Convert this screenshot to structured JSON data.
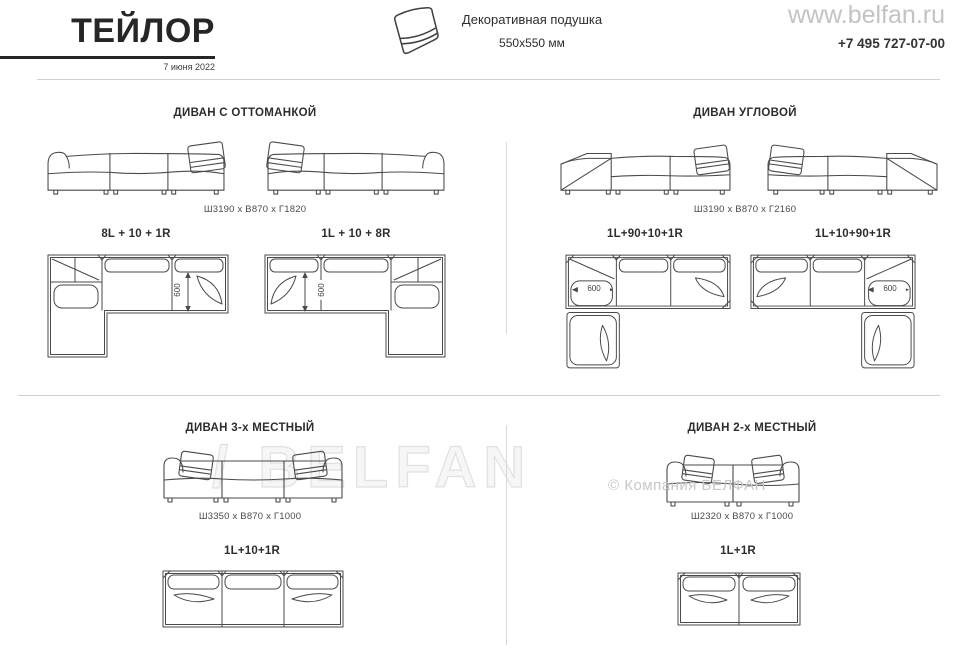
{
  "header": {
    "title": "ТЕЙЛОР",
    "date": "7 июня 2022",
    "pillow": {
      "line1": "Декоративная подушка",
      "line2": "550x550 мм"
    },
    "website": "www.belfan.ru",
    "phone": "+7 495 727-07-00"
  },
  "watermarks": {
    "brand": "/ BELFAN",
    "copyright": "© Компания БЕЛФАН"
  },
  "sections": {
    "ottoman": {
      "title": "ДИВАН С ОТТОМАНКОЙ",
      "dimensions": "Ш3190 x В870 x Г1820",
      "config_left": "8L + 10 + 1R",
      "config_right": "1L + 10 + 8R",
      "seat_depth": "600"
    },
    "corner": {
      "title": "ДИВАН УГЛОВОЙ",
      "dimensions": "Ш3190 x В870 x Г2160",
      "config_left": "1L+90+10+1R",
      "config_right": "1L+10+90+1R",
      "seat_depth": "600"
    },
    "three_seat": {
      "title": "ДИВАН 3-х МЕСТНЫЙ",
      "dimensions": "Ш3350 x В870 x Г1000",
      "config": "1L+10+1R"
    },
    "two_seat": {
      "title": "ДИВАН 2-х МЕСТНЫЙ",
      "dimensions": "Ш2320 x В870 x Г1000",
      "config": "1L+1R"
    }
  }
}
